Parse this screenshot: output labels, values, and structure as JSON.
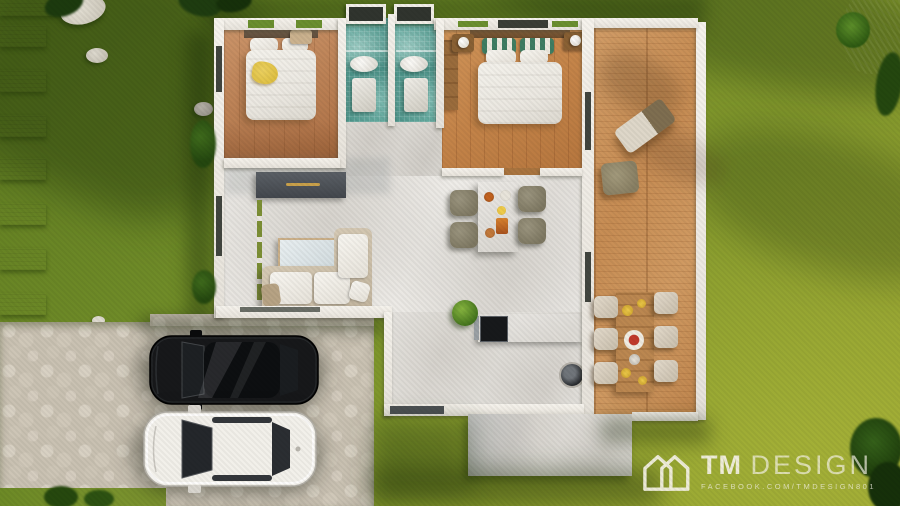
{
  "watermark": {
    "brand_bold": "TM",
    "brand_light": "DESIGN",
    "subtitle": "FACEBOOK.COM/TMDESIGN801",
    "logo_icon": "double-house-outline-icon"
  },
  "colors": {
    "grass-dark": "#5d7a20",
    "grass-mid": "#74902a",
    "grass-light": "#98a432",
    "slab": "#cdc6b7",
    "cobble": "#c9c1b2",
    "marble": "#f0eeea",
    "wood-1": "#bd8357",
    "wood-2": "#c48449",
    "deck-wood": "#c78d54",
    "bath-tile": "#478e84",
    "wall": "#f6f3ed",
    "counter-dark": "#33383e",
    "sofa-beige": "#d6cab5",
    "chair-olive": "#7e7862",
    "throw-yellow": "#dfc043",
    "car-black": "#121314",
    "car-white": "#f4f2ee",
    "watermark": "#f6f3e6"
  }
}
